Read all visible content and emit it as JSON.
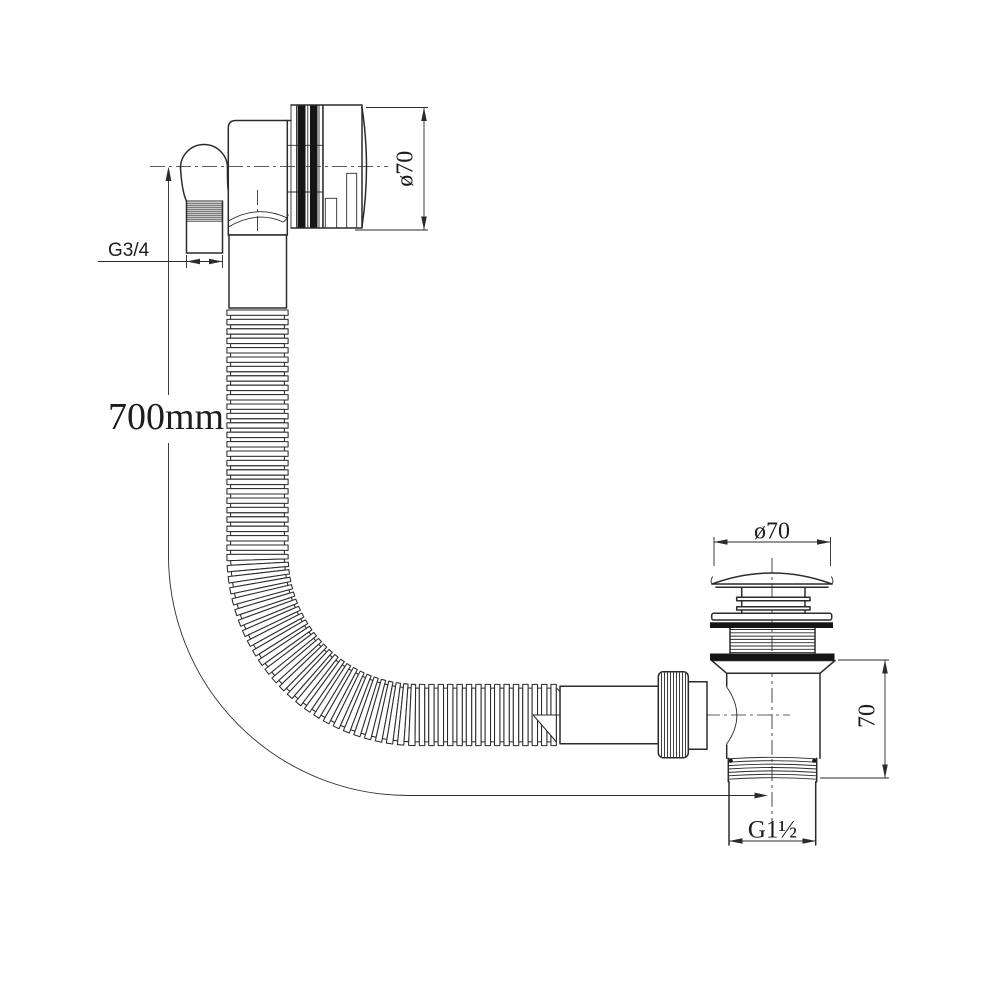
{
  "drawing": {
    "line_color": "#2b2b2b",
    "background": "#ffffff"
  },
  "dimensions": {
    "hose_length": "700mm",
    "overflow_thread": "G3/4",
    "overflow_face_diameter": "ø70",
    "waste_cap_diameter": "ø70",
    "waste_body_height": "70",
    "waste_outlet_thread": "G1½"
  }
}
